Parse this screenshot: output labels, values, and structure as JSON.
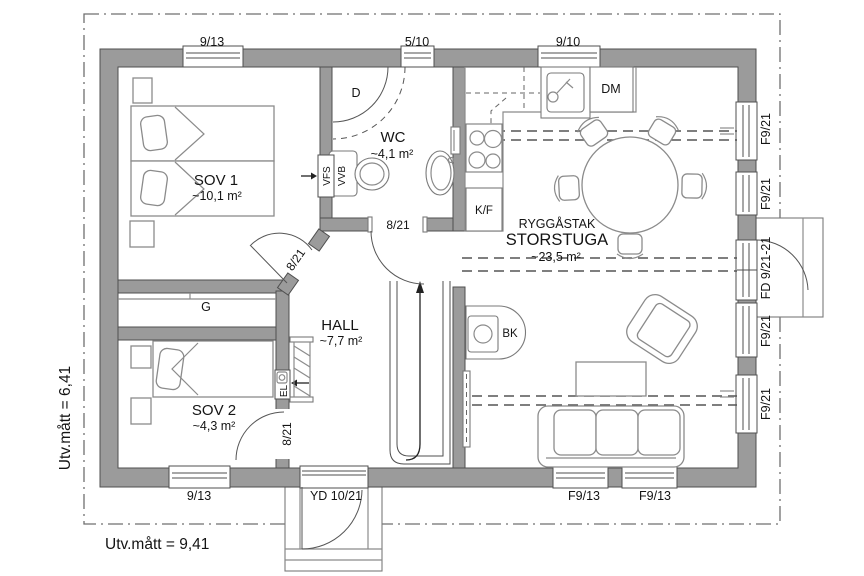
{
  "plan": {
    "outer_width_label": "Utv.mått = 9,41",
    "outer_height_label": "Utv.mått = 6,41",
    "rooms": {
      "sov1": {
        "name": "SOV 1",
        "area": "~10,1 m²"
      },
      "sov2": {
        "name": "SOV 2",
        "area": "~4,3 m²"
      },
      "wc": {
        "name": "WC",
        "area": "~4,1 m²"
      },
      "hall": {
        "name": "HALL",
        "area": "~7,7 m²"
      },
      "storstuga": {
        "name": "STORSTUGA",
        "area": "~23,5 m²",
        "ceiling_note": "RYGGÅSTAK"
      }
    },
    "fixtures": {
      "closet": "G",
      "shower": "D",
      "fridge_freezer": "K/F",
      "dishwasher": "DM",
      "wood_stove": "BK",
      "water_heater": "VVB",
      "vent_shaft": "VFS",
      "electrical_panel": "EL"
    },
    "windows": {
      "top": [
        "9/13",
        "5/10",
        "9/10"
      ],
      "right": [
        "F9/21",
        "F9/21",
        "F9/21",
        "F9/21"
      ],
      "right_door": "FD 9/21-21",
      "bottom": [
        "9/13",
        "F9/13",
        "F9/13"
      ]
    },
    "doors": {
      "entry": "YD 10/21",
      "wc": "8/21",
      "sov1": "8/21",
      "sov2": "8/21"
    },
    "colors": {
      "wall_fill": "#9b9b9b",
      "wall_line": "#4f4f4f",
      "furniture_line": "#8b8b8b",
      "text": "#141414"
    }
  }
}
